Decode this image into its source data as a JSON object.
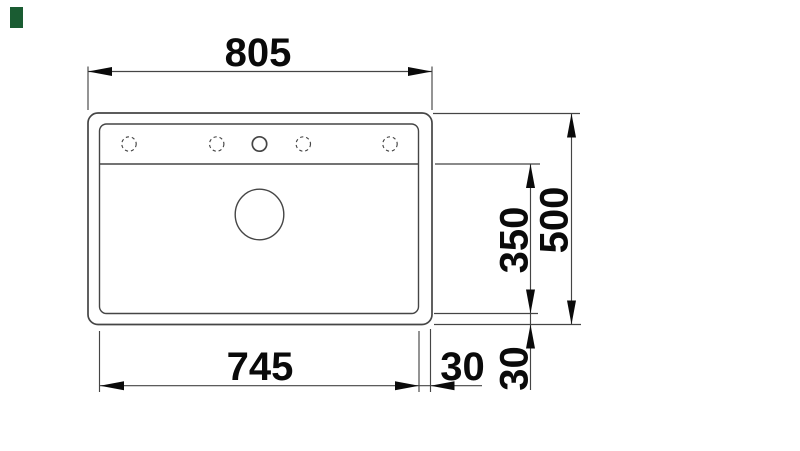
{
  "colors": {
    "background": "#ffffff",
    "line": "#454545",
    "ink": "#0a0a0a",
    "brand_green": "#1a5c32"
  },
  "dimensions": {
    "overall_width": "805",
    "bowl_width": "745",
    "right_rim": "30",
    "bowl_depth": "350",
    "overall_depth": "500",
    "bottom_rim": "30"
  },
  "features": {
    "tap_hole_count": 5,
    "dashed_tap_holes": 4,
    "solid_tap_holes": 1,
    "drain_count": 1
  }
}
